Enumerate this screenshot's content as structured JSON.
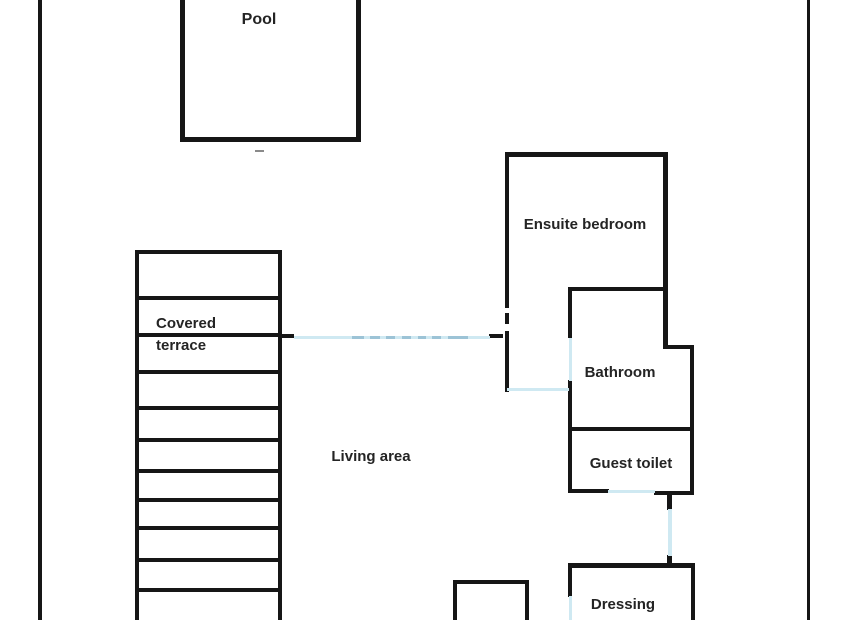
{
  "colors": {
    "wall": "#161616",
    "door": "#cfe9f2",
    "door_accent": "#9cc3d6",
    "text": "#242424",
    "tick": "#8a8a8a",
    "background": "#ffffff"
  },
  "rooms": {
    "pool": "Pool",
    "ensuite_bedroom": "Ensuite bedroom",
    "covered_terrace_line1": "Covered",
    "covered_terrace_line2": "terrace",
    "bathroom": "Bathroom",
    "guest_toilet": "Guest toilet",
    "living_area": "Living area",
    "dressing": "Dressing"
  },
  "plan": {
    "walls": [
      {
        "name": "outer-border-left",
        "rect": [
          38,
          0,
          4,
          620
        ]
      },
      {
        "name": "outer-border-right",
        "rect": [
          807,
          0,
          3,
          620
        ]
      },
      {
        "name": "pool-wall-left",
        "rect": [
          180,
          0,
          5,
          142
        ]
      },
      {
        "name": "pool-wall-right",
        "rect": [
          356,
          0,
          5,
          142
        ]
      },
      {
        "name": "pool-wall-bottom",
        "rect": [
          180,
          137,
          181,
          5
        ]
      },
      {
        "name": "terrace-wall-top",
        "rect": [
          135,
          250,
          147,
          4
        ]
      },
      {
        "name": "terrace-wall-left",
        "rect": [
          135,
          250,
          4,
          370
        ]
      },
      {
        "name": "terrace-wall-right",
        "rect": [
          278,
          250,
          4,
          370
        ]
      },
      {
        "name": "terrace-slat-1",
        "rect": [
          135,
          296,
          147,
          4
        ]
      },
      {
        "name": "terrace-slat-2",
        "rect": [
          135,
          333,
          147,
          4
        ]
      },
      {
        "name": "terrace-slat-3",
        "rect": [
          135,
          370,
          147,
          4
        ]
      },
      {
        "name": "terrace-slat-4",
        "rect": [
          135,
          406,
          147,
          4
        ]
      },
      {
        "name": "terrace-slat-5",
        "rect": [
          135,
          438,
          147,
          4
        ]
      },
      {
        "name": "terrace-slat-6",
        "rect": [
          135,
          469,
          147,
          4
        ]
      },
      {
        "name": "terrace-slat-7",
        "rect": [
          135,
          498,
          147,
          4
        ]
      },
      {
        "name": "terrace-slat-8",
        "rect": [
          135,
          526,
          147,
          4
        ]
      },
      {
        "name": "terrace-slat-9",
        "rect": [
          135,
          558,
          147,
          4
        ]
      },
      {
        "name": "terrace-slat-10",
        "rect": [
          135,
          588,
          147,
          4
        ]
      },
      {
        "name": "ensuite-wall-top",
        "rect": [
          505,
          152,
          163,
          5
        ]
      },
      {
        "name": "ensuite-wall-left-upper",
        "rect": [
          505,
          152,
          4,
          156
        ]
      },
      {
        "name": "ensuite-wall-left-dash",
        "rect": [
          505,
          313,
          4,
          11
        ]
      },
      {
        "name": "ensuite-wall-left-lower",
        "rect": [
          505,
          331,
          4,
          61
        ]
      },
      {
        "name": "ensuite-wall-right",
        "rect": [
          663,
          152,
          5,
          197
        ]
      },
      {
        "name": "bathroom-jut-wall",
        "rect": [
          663,
          345,
          31,
          4
        ]
      },
      {
        "name": "right-wall-lower",
        "rect": [
          690,
          345,
          4,
          150
        ]
      },
      {
        "name": "bathroom-wall-top",
        "rect": [
          568,
          287,
          100,
          4
        ]
      },
      {
        "name": "bathroom-wall-left-upper",
        "rect": [
          568,
          287,
          4,
          51
        ]
      },
      {
        "name": "bathroom-wall-left-lower",
        "rect": [
          568,
          380,
          4,
          112
        ]
      },
      {
        "name": "bathroom-guest-divider",
        "rect": [
          568,
          427,
          126,
          4
        ]
      },
      {
        "name": "guest-toilet-bottom-left",
        "rect": [
          568,
          489,
          41,
          4
        ]
      },
      {
        "name": "guest-toilet-bottom-right",
        "rect": [
          654,
          491,
          40,
          4
        ]
      },
      {
        "name": "connector-stub-top",
        "rect": [
          667,
          493,
          5,
          17
        ]
      },
      {
        "name": "connector-stub-bottom",
        "rect": [
          667,
          555,
          5,
          12
        ]
      },
      {
        "name": "dressing-wall-top",
        "rect": [
          568,
          563,
          127,
          5
        ]
      },
      {
        "name": "dressing-wall-left",
        "rect": [
          568,
          563,
          4,
          34
        ]
      },
      {
        "name": "dressing-wall-right",
        "rect": [
          691,
          563,
          4,
          57
        ]
      },
      {
        "name": "small-room-wall-top",
        "rect": [
          453,
          580,
          76,
          4
        ]
      },
      {
        "name": "small-room-wall-left",
        "rect": [
          453,
          580,
          4,
          40
        ]
      },
      {
        "name": "small-room-wall-right",
        "rect": [
          525,
          582,
          4,
          38
        ]
      },
      {
        "name": "corridor-stub-left",
        "rect": [
          281,
          334,
          13,
          4
        ]
      },
      {
        "name": "corridor-dash-right",
        "rect": [
          489,
          334,
          14,
          4
        ]
      }
    ],
    "doors": [
      {
        "name": "corridor-door-long",
        "rect": [
          294,
          336,
          196,
          3
        ]
      },
      {
        "name": "bathroom-door",
        "rect": [
          569,
          338,
          3,
          43
        ]
      },
      {
        "name": "corridor-door-bottom",
        "rect": [
          507,
          388,
          62,
          3
        ]
      },
      {
        "name": "guest-toilet-door",
        "rect": [
          608,
          490,
          47,
          3
        ]
      },
      {
        "name": "hall-connector",
        "rect": [
          668,
          509,
          4,
          47
        ]
      },
      {
        "name": "dressing-door",
        "rect": [
          569,
          596,
          3,
          24
        ]
      }
    ],
    "door_dashes": [
      {
        "name": "corridor-dash-a",
        "rect": [
          352,
          336,
          12,
          3
        ]
      },
      {
        "name": "corridor-dash-b",
        "rect": [
          370,
          336,
          10,
          3
        ]
      },
      {
        "name": "corridor-dash-c",
        "rect": [
          386,
          336,
          9,
          3
        ]
      },
      {
        "name": "corridor-dash-d",
        "rect": [
          402,
          336,
          9,
          3
        ]
      },
      {
        "name": "corridor-dash-e",
        "rect": [
          418,
          336,
          8,
          3
        ]
      },
      {
        "name": "corridor-dash-f",
        "rect": [
          432,
          336,
          9,
          3
        ]
      },
      {
        "name": "corridor-dash-g",
        "rect": [
          448,
          336,
          20,
          3
        ]
      }
    ],
    "marks": [
      {
        "name": "pool-edge-tick",
        "rect": [
          255,
          150,
          9,
          2
        ]
      }
    ]
  }
}
